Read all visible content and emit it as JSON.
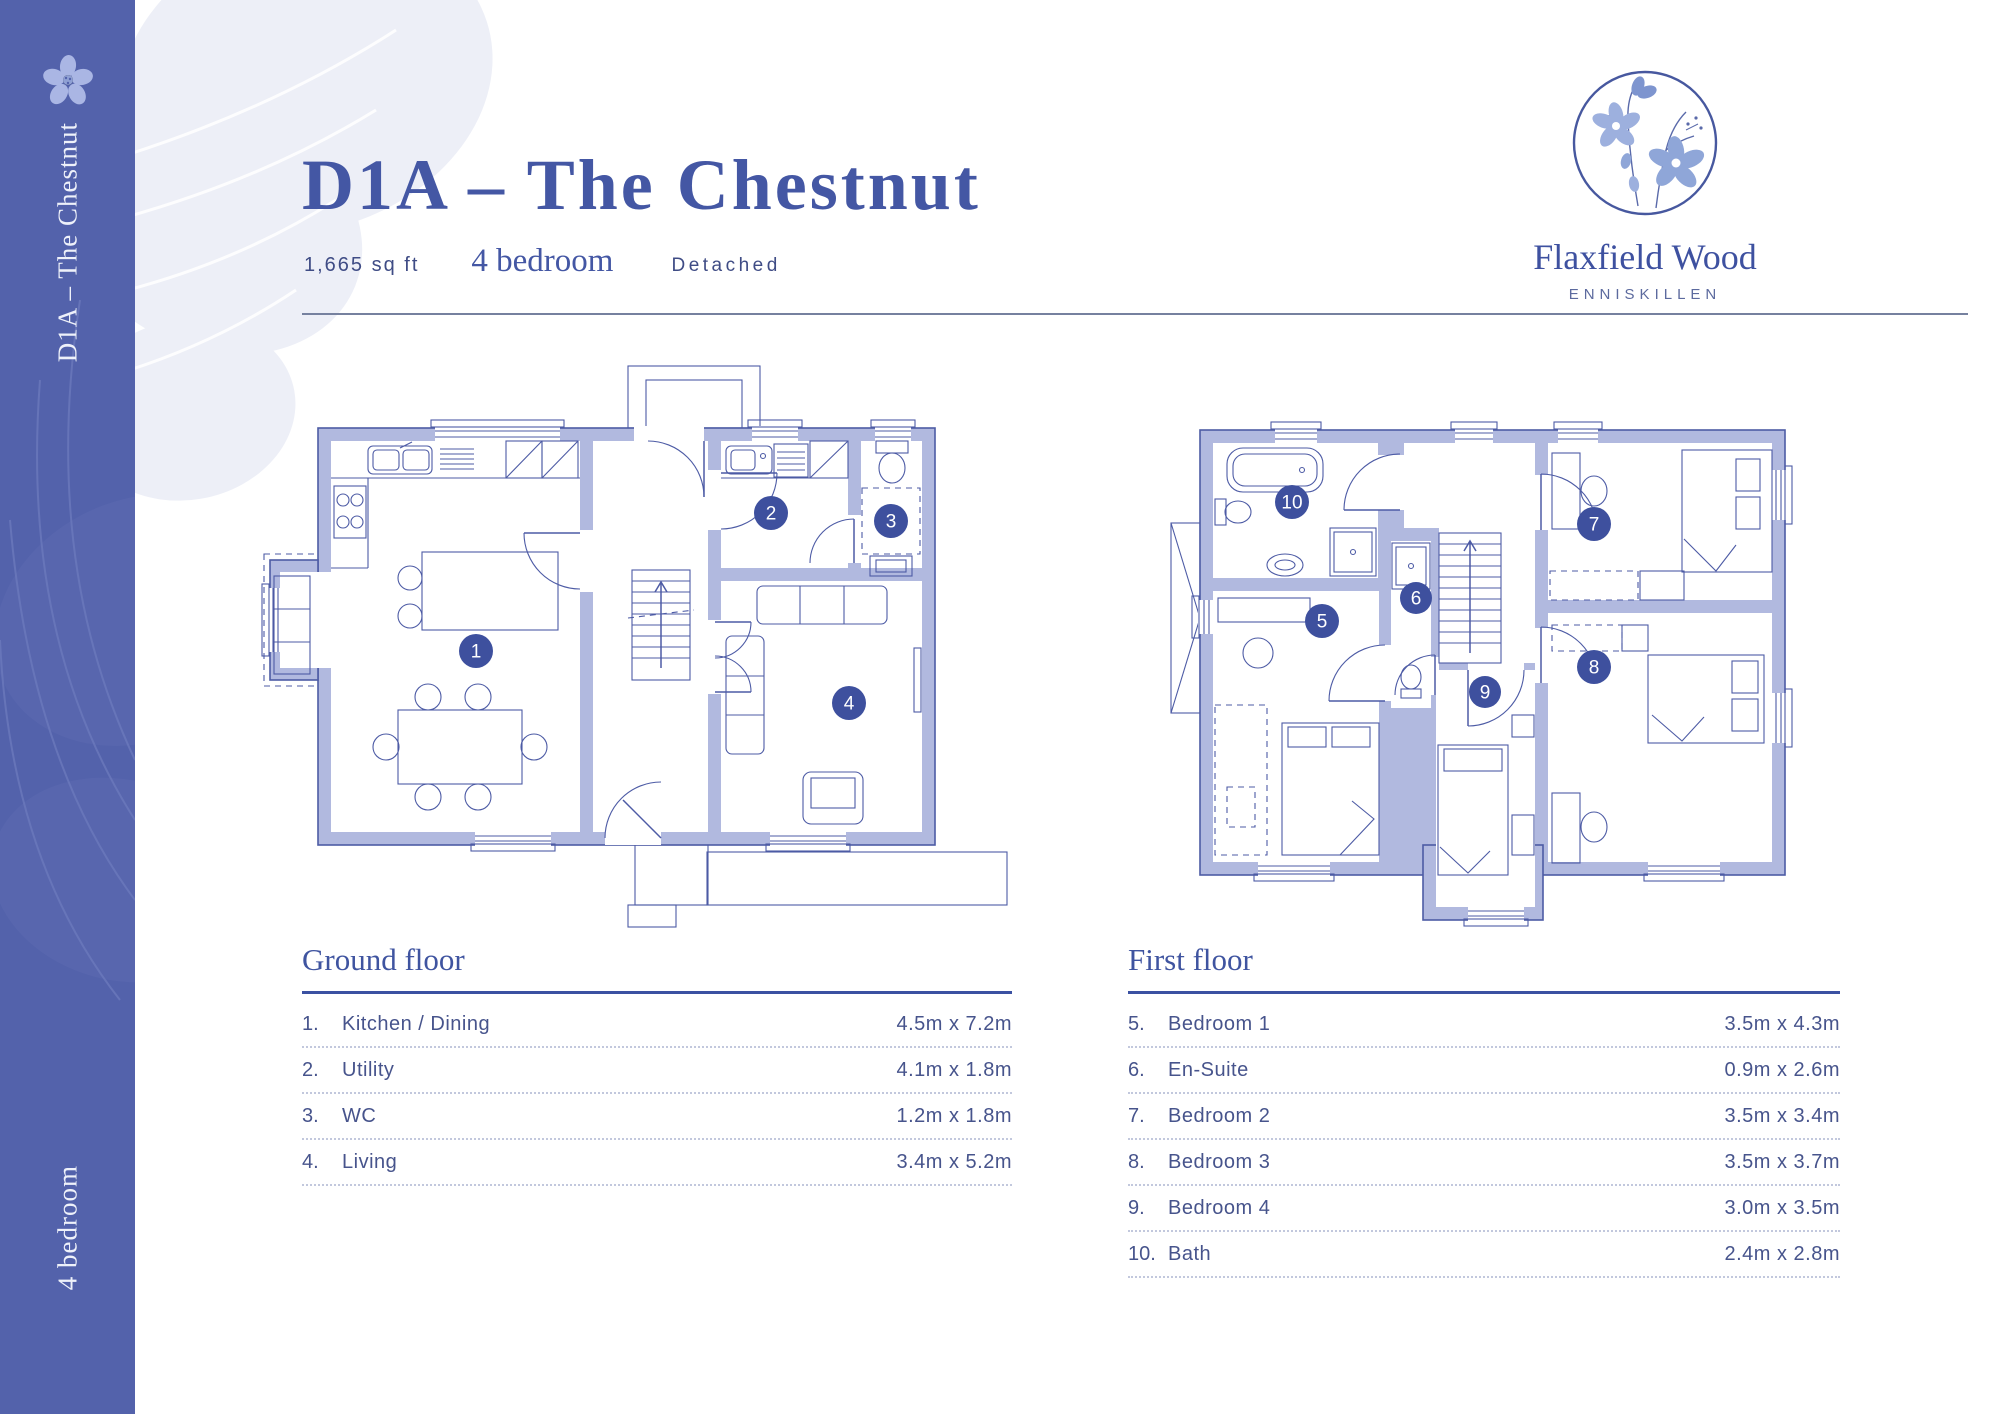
{
  "sidebar": {
    "top_label": "D1A – The Chestnut",
    "bottom_label": "4 bedroom",
    "color": "#5362ab",
    "flower_icon": "flax-flower-icon"
  },
  "header": {
    "title": "D1A – The Chestnut",
    "area": "1,665 sq ft",
    "bedrooms": "4 bedroom",
    "type": "Detached"
  },
  "logo": {
    "icon": "flax-flowers-circle-icon",
    "name": "Flaxfield Wood",
    "location": "ENNISKILLEN"
  },
  "colors": {
    "accent_blue": "#4457a4",
    "sidebar_blue": "#5362ab",
    "wall_fill": "#b1b9df",
    "plan_line": "#4d5ba5",
    "marker_fill": "#3e509e",
    "text_blue": "#47548c"
  },
  "plans": {
    "ground": {
      "name": "Ground floor plan",
      "markers": [
        {
          "label": "1"
        },
        {
          "label": "2"
        },
        {
          "label": "3"
        },
        {
          "label": "4"
        }
      ]
    },
    "first": {
      "name": "First floor plan",
      "markers": [
        {
          "label": "5"
        },
        {
          "label": "6"
        },
        {
          "label": "7"
        },
        {
          "label": "8"
        },
        {
          "label": "9"
        },
        {
          "label": "10"
        }
      ]
    }
  },
  "legends": [
    {
      "title": "Ground floor",
      "rows": [
        {
          "num": "1.",
          "name": "Kitchen / Dining",
          "dims": "4.5m x 7.2m"
        },
        {
          "num": "2.",
          "name": "Utility",
          "dims": "4.1m x 1.8m"
        },
        {
          "num": "3.",
          "name": "WC",
          "dims": "1.2m x 1.8m"
        },
        {
          "num": "4.",
          "name": "Living",
          "dims": "3.4m x 5.2m"
        }
      ]
    },
    {
      "title": "First floor",
      "rows": [
        {
          "num": "5.",
          "name": "Bedroom 1",
          "dims": "3.5m x 4.3m"
        },
        {
          "num": "6.",
          "name": "En-Suite",
          "dims": "0.9m x 2.6m"
        },
        {
          "num": "7.",
          "name": "Bedroom 2",
          "dims": "3.5m x 3.4m"
        },
        {
          "num": "8.",
          "name": "Bedroom 3",
          "dims": "3.5m x 3.7m"
        },
        {
          "num": "9.",
          "name": "Bedroom 4",
          "dims": "3.0m x 3.5m"
        },
        {
          "num": "10.",
          "name": "Bath",
          "dims": "2.4m x 2.8m"
        }
      ]
    }
  ]
}
